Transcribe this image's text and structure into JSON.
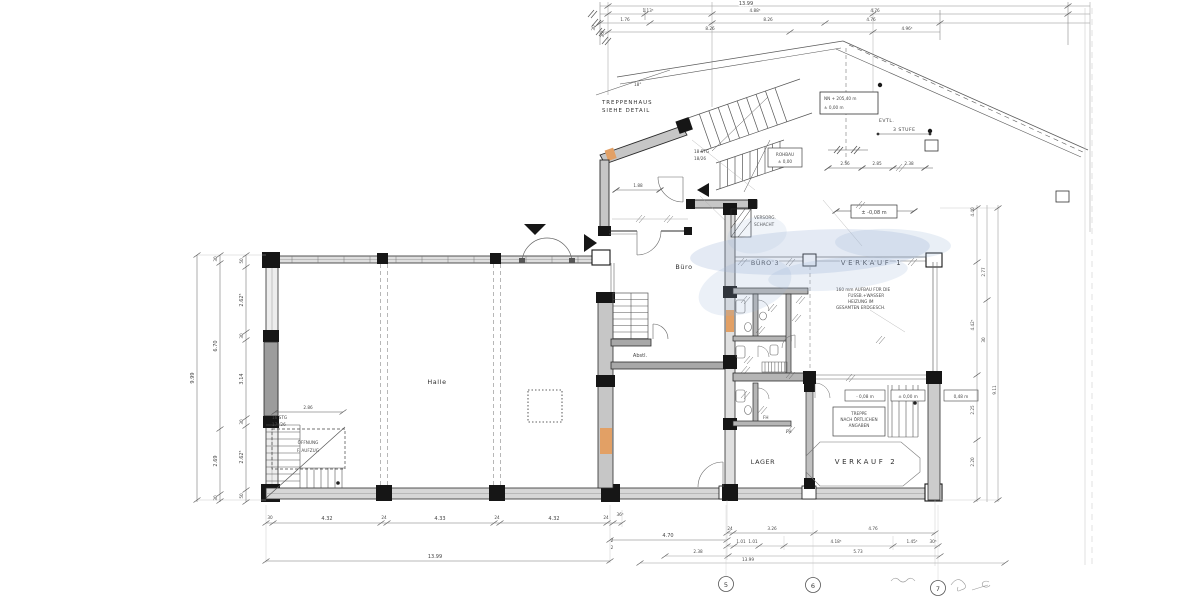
{
  "colors": {
    "paper": "#ffffff",
    "ink": "#3f3f3f",
    "wall_fill": "#c6c6c6",
    "wall_dark": "#161616",
    "accent_orange": "#e2a065",
    "wash_blue": "#9db4d6"
  },
  "rooms": {
    "halle": "Halle",
    "buero": "Büro",
    "abstell": "Abstl.",
    "buero3": "BÜRO 3",
    "verkauf1": "VERKAUF 1",
    "verkauf2": "VERKAUF 2",
    "lager": "LAGER",
    "versorg1": "VERSORG.",
    "versorg2": "SCHACHT"
  },
  "notes": {
    "treppenhaus1": "TREPPENHAUS",
    "treppenhaus2": "SIEHE DETAIL",
    "angle": "18°",
    "oeffnung1": "ÖFFNUNG",
    "oeffnung2": "F. AUFZUG",
    "stair_left1": "16 STG",
    "stair_left2": "17⁵/26",
    "stair_entry1": "18 STG",
    "stair_entry2": "18/26",
    "rohbau1": "ROHBAU",
    "rohbau2": "± 0,00",
    "nn1": "NN + 205,40 m",
    "nn2": "± 0,00 m",
    "evtl1": "EVTL.",
    "evtl2": "3 STUFE",
    "heizung1": "160 mm AUFBAU FÜR DIE",
    "heizung2": "FUSSB.+WASSER",
    "heizung3": "HEIZUNG IM",
    "heizung4": "GESAMTEN ERDGESCH.",
    "treppe1": "TREPPE",
    "treppe2": "NACH ÖRTLICHEN",
    "treppe3": "ANGABEN",
    "fh": "FH"
  },
  "levels": {
    "minus008_plus": "± -0,08 m",
    "minus008": "- 0,08 m",
    "zero": "± 0,00 m",
    "h048": "0,48 m"
  },
  "grid_bubbles": [
    "5",
    "6",
    "7"
  ],
  "dims": {
    "left_total": "9.99",
    "left_mid": [
      "30",
      "6.70",
      "2.69",
      "30"
    ],
    "left_inner": [
      "50",
      "2.62⁵",
      "30",
      "3.14",
      "30",
      "2.62⁵",
      "50"
    ],
    "stair_width": "2.86",
    "door_width": "1.88",
    "bottom": [
      "30",
      "4.32",
      "24",
      "4.33",
      "24",
      "4.32",
      "24",
      "36⁵"
    ],
    "bottom_sub": [
      "2",
      "2"
    ],
    "bottom_total": "13.99",
    "mid": "4.70",
    "right_r1": [
      "24",
      "3.26",
      "4.76"
    ],
    "right_r2": [
      "1.01",
      "1.01",
      "4.18⁵",
      "1.45⁵",
      "30⁵"
    ],
    "right_r3": [
      "2.38",
      "5.73"
    ],
    "right_total": "13.99",
    "top_total": "13.99",
    "top_r2": [
      "1.13⁵",
      "4.88⁵",
      "4.76"
    ],
    "top_r3": [
      "1.76",
      "8.26",
      "4.76"
    ],
    "top_r4": [
      "8.26",
      "4.96⁵"
    ],
    "top_side": [
      "30",
      "36⁵"
    ],
    "vert_right": [
      "4.40",
      "2.77",
      "4.42⁵",
      "30",
      "2.25",
      "9.11",
      "2.20"
    ],
    "canopy": [
      "2.56",
      "2.85",
      "2.38"
    ]
  }
}
